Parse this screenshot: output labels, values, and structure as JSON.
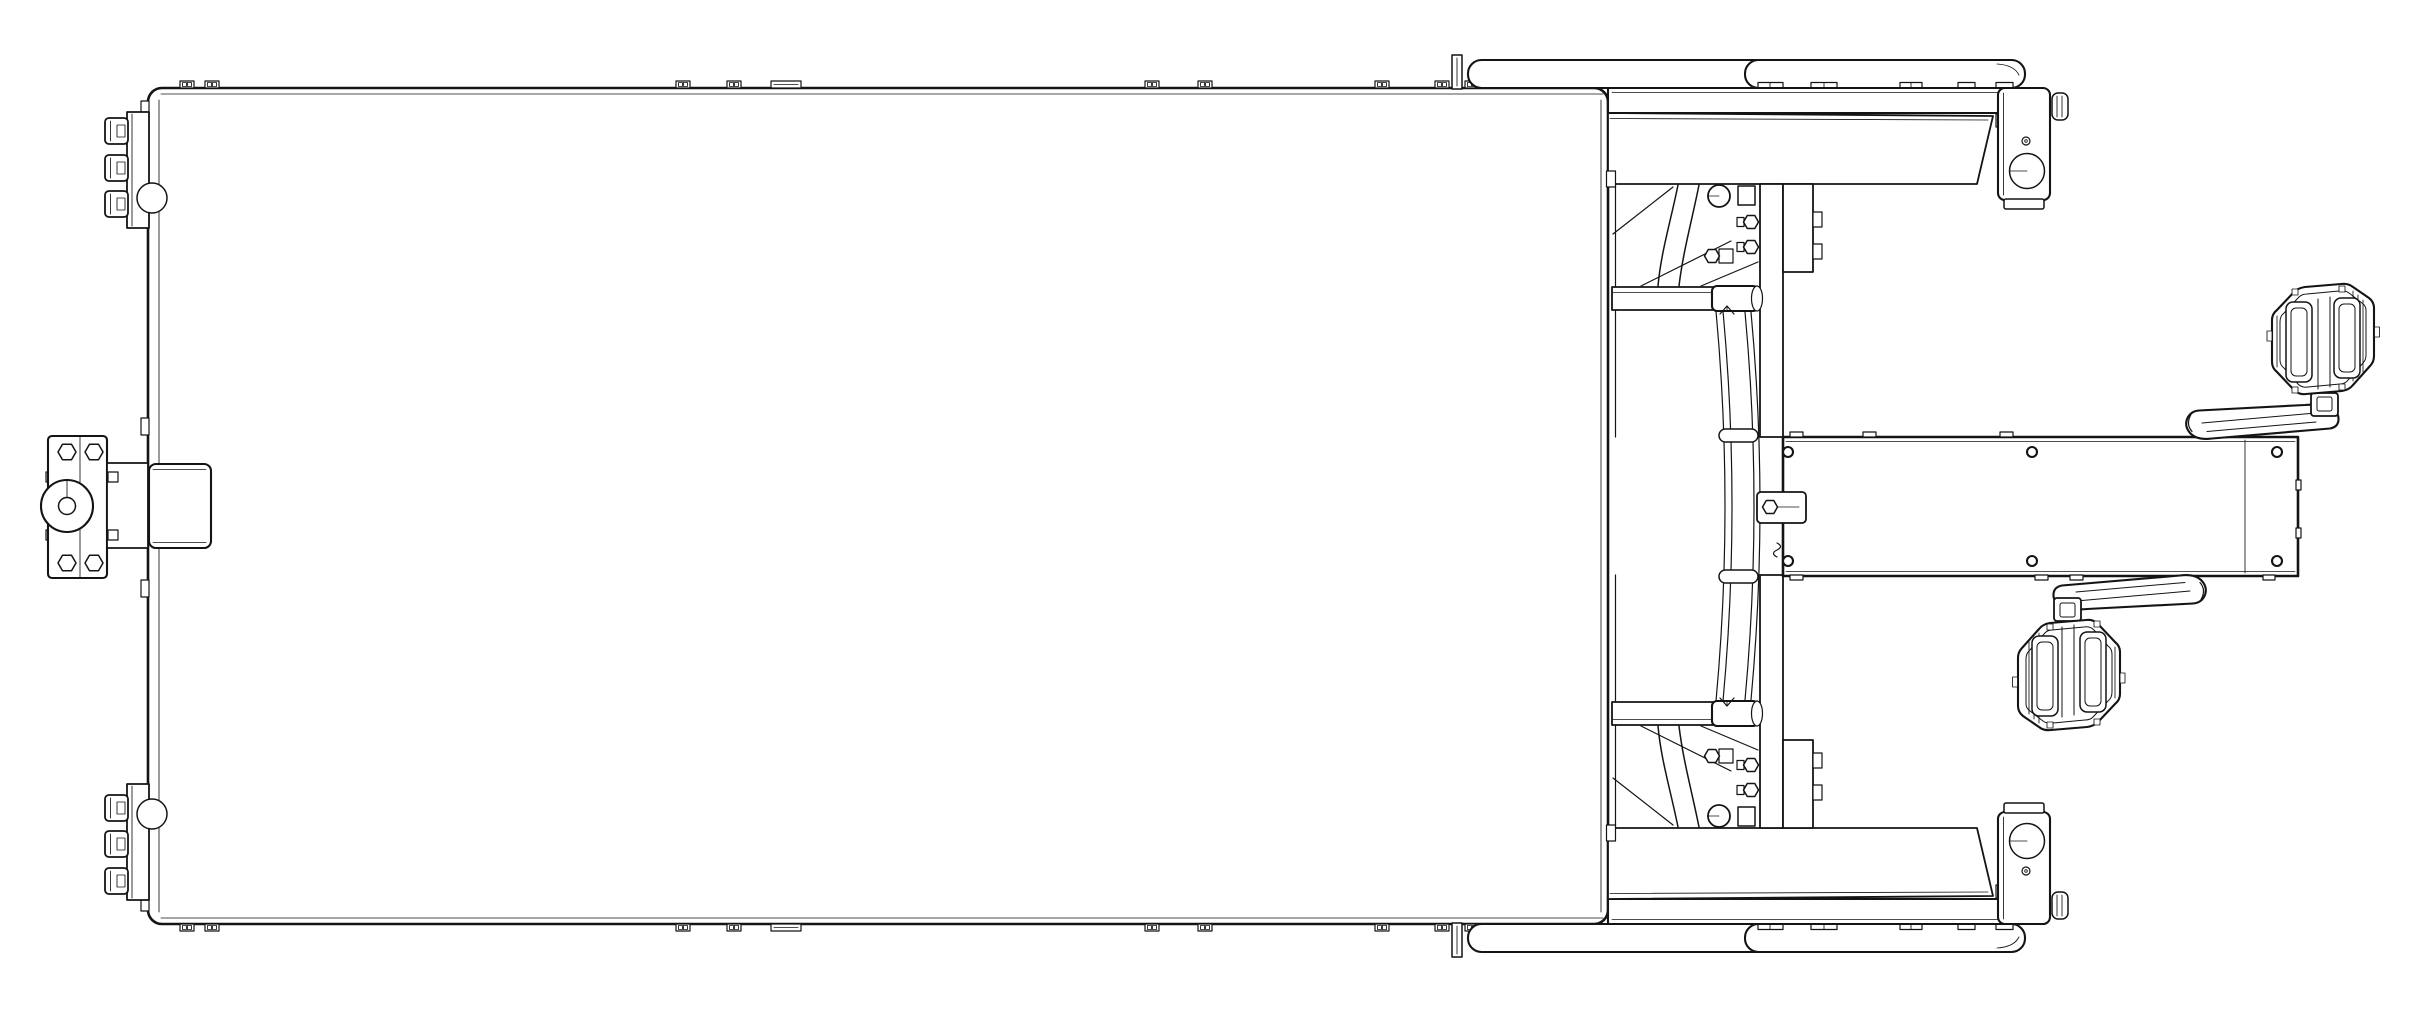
{
  "document": {
    "type": "technical-line-drawing",
    "title": "Pedal vehicle chassis - orthographic top view",
    "projection": "top view",
    "background_color": "#ffffff",
    "line_color": "#141414",
    "hidden_line_style": "dashed"
  },
  "canvas": {
    "width": 2409,
    "height": 1020
  },
  "parts": {
    "deck": {
      "label": "Cargo deck panel"
    },
    "edge_clips": {
      "label": "Deck edge mounting clips",
      "count": 26
    },
    "hinge_top": {
      "label": "Hinge hardware cluster, upper left edge"
    },
    "hinge_bottom": {
      "label": "Hinge hardware cluster, lower left edge"
    },
    "hitch": {
      "label": "Front hitch bracket with hub and mount box"
    },
    "side_top": {
      "label": "Side rail, fender and wheel bracket, upper side"
    },
    "side_bottom": {
      "label": "Side rail, fender and wheel bracket, lower side"
    },
    "frame_top": {
      "label": "Support frame tubes and plates, upper half"
    },
    "frame_bottom": {
      "label": "Support frame tubes and plates, lower half"
    },
    "spring": {
      "label": "Curved spring member between cross tubes"
    },
    "boom": {
      "label": "Drive boom with bolt holes",
      "hole_count": 6
    },
    "crank_right": {
      "label": "Crank arm with platform pedal, right side"
    },
    "crank_left": {
      "label": "Crank arm with platform pedal, left side"
    }
  }
}
